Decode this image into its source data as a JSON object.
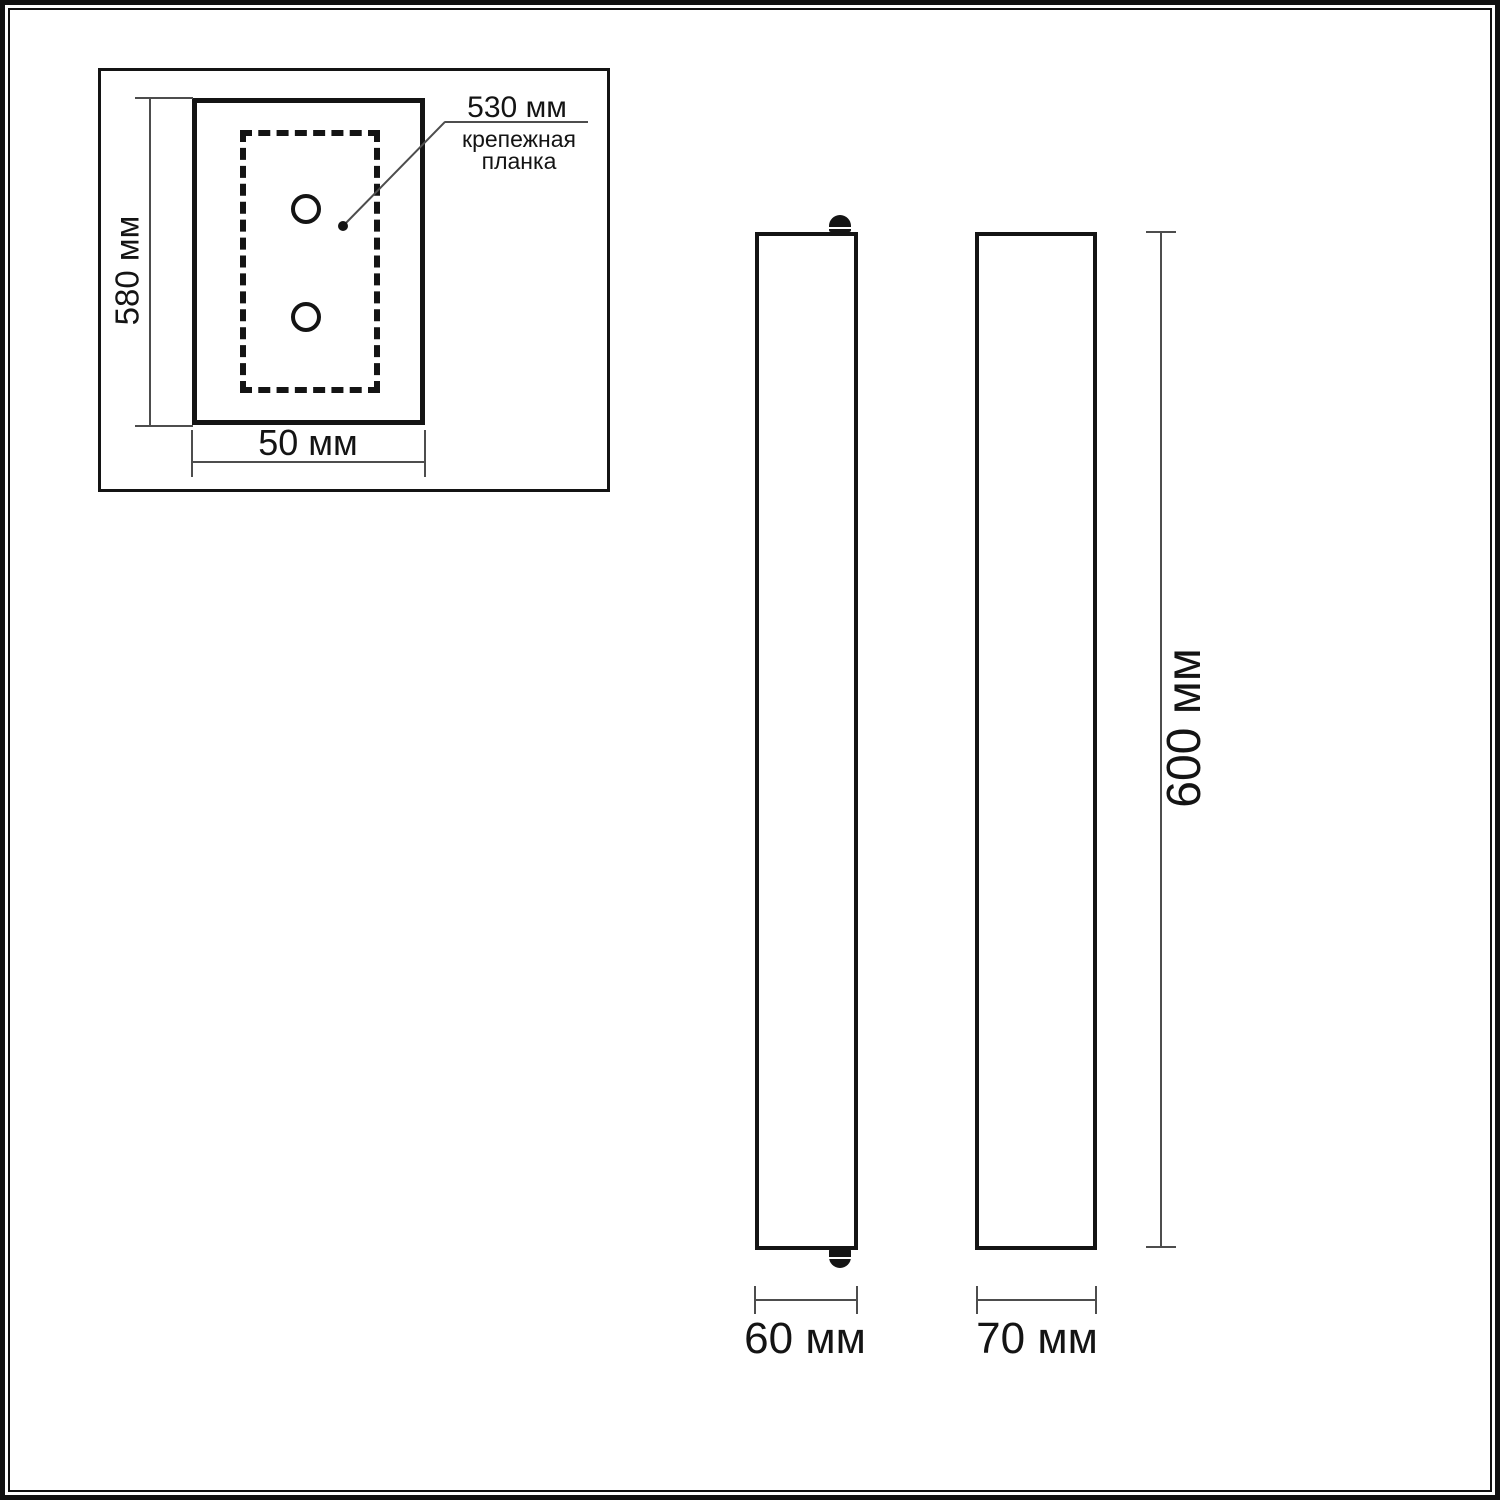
{
  "diagram": {
    "type": "product-dimension-drawing",
    "colors": {
      "stroke": "#141414",
      "dim_line": "#4d4d4d",
      "background": "#ffffff"
    },
    "inset": {
      "height_dim": "580 мм",
      "width_dim": "50 мм",
      "callout_dim": "530 мм",
      "callout_label_line1": "крепежная",
      "callout_label_line2": "планка",
      "mounting_holes": 2
    },
    "front_view": {
      "width_dim": "60 мм"
    },
    "side_view": {
      "width_dim": "70 мм"
    },
    "height_dim": "600 мм"
  }
}
